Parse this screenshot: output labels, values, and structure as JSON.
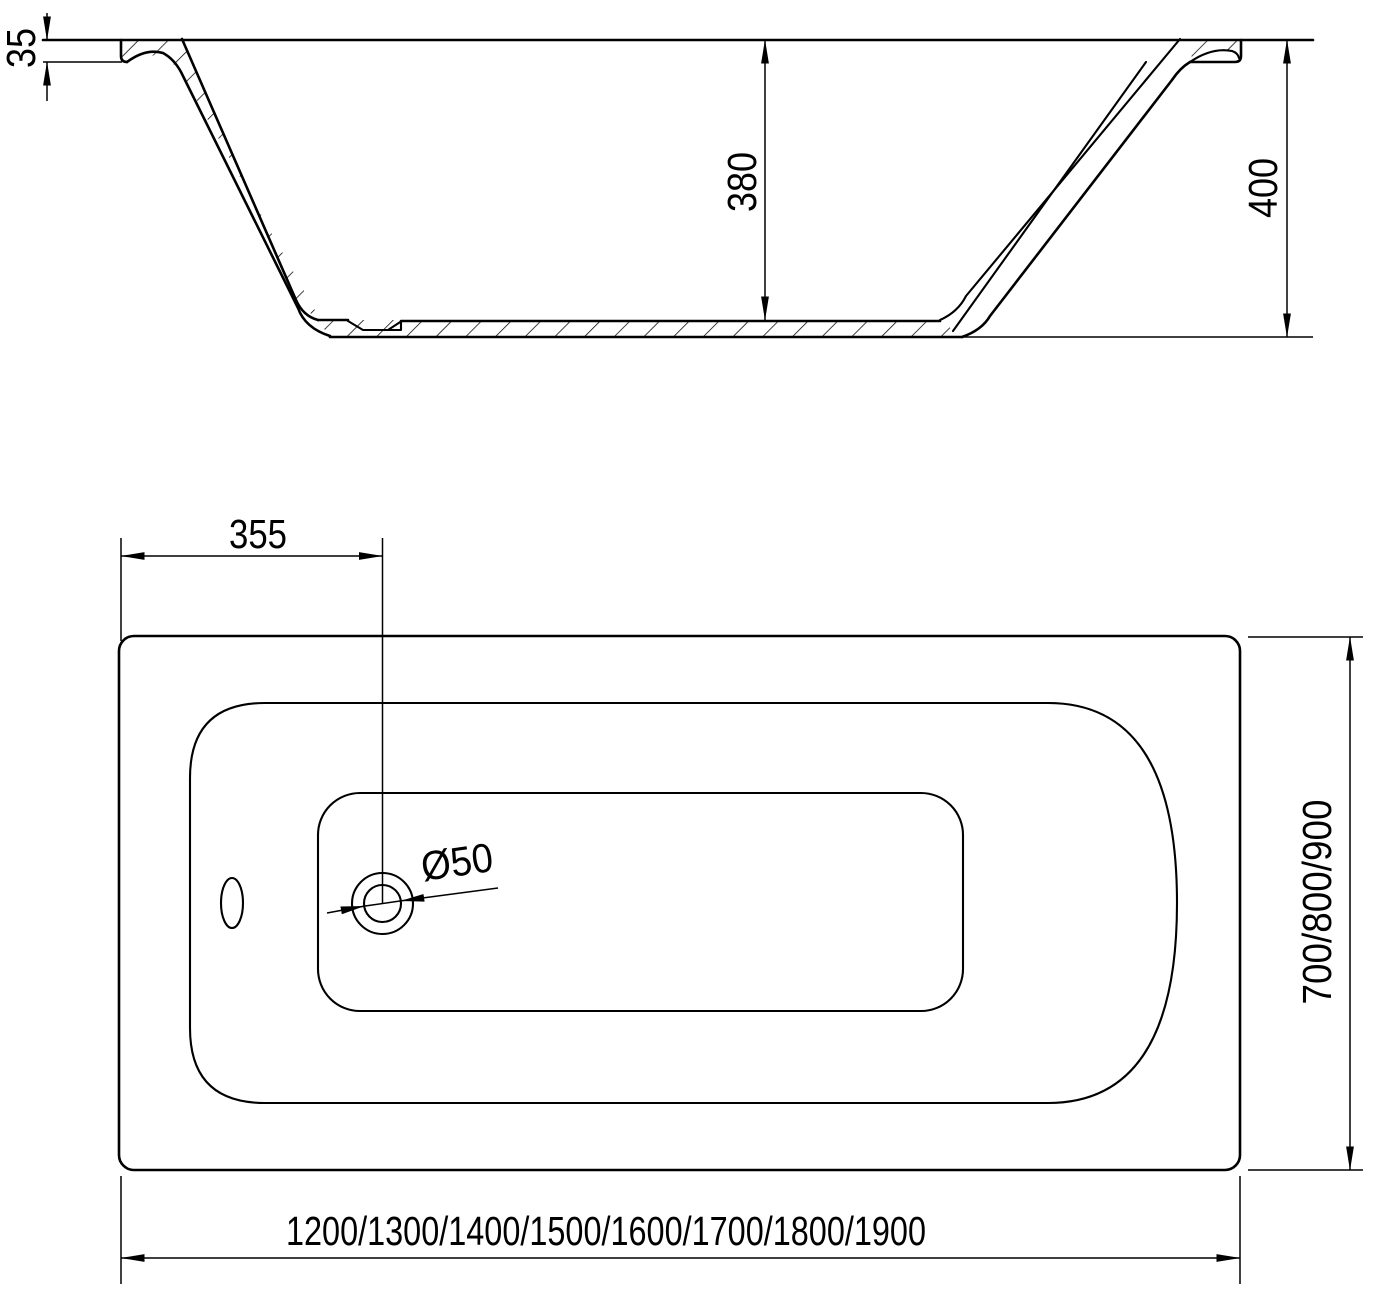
{
  "drawing": {
    "side_view": {
      "rim_thickness_mm": "35",
      "inner_depth_mm": "380",
      "overall_height_mm": "400"
    },
    "plan_view": {
      "drain_offset_mm": "355",
      "drain_diameter_label": "Ø50",
      "width_options_mm": "700/800/900",
      "length_options_mm": "1200/1300/1400/1500/1600/1700/1800/1900"
    },
    "colors": {
      "line": "#000000",
      "background": "#ffffff"
    }
  }
}
